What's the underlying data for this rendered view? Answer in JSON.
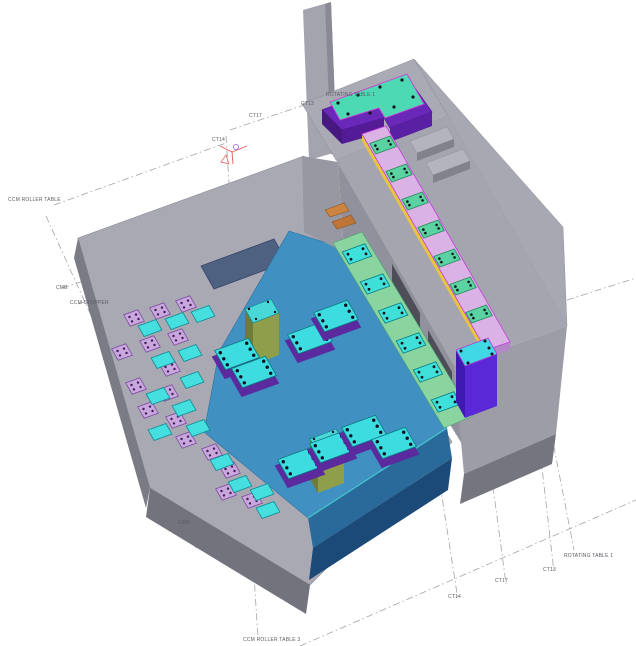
{
  "view": {
    "type": "isometric-3d-plant-layout",
    "description": "CAD 3D view of CCM roller table and rotating table area"
  },
  "labels": {
    "ccm_roller_table": "CCM ROLLER TABLE",
    "cmb_upper": "CMB",
    "ccm_stopper": "CCM STOPPER",
    "ct14_upper": "CT14",
    "ct17_upper": "CT17",
    "ct13_upper": "CT13",
    "rotating_table_upper": "ROTATING TABLE 1",
    "rotating_table_lower": "ROTATING TABLE 1",
    "ct13_lower": "CT13",
    "ct17_lower": "CT17",
    "ct14_lower": "CT14",
    "cmb_lower": "CMB",
    "ccm_roller_table_3": "CCM ROLLER TABLE 3"
  },
  "palette": {
    "deck_gray": "#a9a9b4",
    "pool_blue": "#4190c2",
    "pool_wall_dark": "#1c4a78",
    "strip_green": "#8ad4a0",
    "rail_pink": "#dbb2e6",
    "rail_outline_magenta": "#c83ae0",
    "safety_yellow": "#e8c53e",
    "table_violet": "#6a28b8",
    "table_top_teal": "#4cd9b4",
    "plate_cyan": "#3fe0da",
    "plate_lavender": "#c9a6dd",
    "pedestal_purple": "#5b28d8",
    "olive_box": "#8e9e4a",
    "ucs_marker_red": "#e05858"
  },
  "scene": {
    "axes": {
      "u": [
        0.94,
        -0.34
      ],
      "v": [
        0.5,
        0.87
      ]
    },
    "plate_types": {
      "lavender": {
        "w": 15,
        "h": 13,
        "fill": "#c9a6dd",
        "stroke": "#7a4a9e",
        "dot": "#3a2050",
        "dots": 4,
        "dr": 1.2
      },
      "deck_cyan": {
        "w": 19,
        "h": 12,
        "fill": "#45dfe0",
        "stroke": "#0e8a94",
        "dots": 0
      },
      "strip_plate": {
        "w": 24,
        "h": 14,
        "fill": "#3fe0da",
        "stroke": "#0b7a80",
        "dot": "#14141c",
        "dots": 4,
        "dr": 1.4
      },
      "rail_plate": {
        "w": 22,
        "h": 12,
        "fill": "#5ad2a2",
        "stroke": "#268a5c",
        "dot": "#14141c",
        "dots": 4,
        "dr": 1.3
      },
      "pool_plate": {
        "w": 36,
        "h": 22,
        "fill": "#3ddce0",
        "stroke": "#0b7a80",
        "dot": "#101020",
        "dots": 6,
        "dr": 1.7,
        "base": "#5a2a9e",
        "baseDy": 7
      }
    },
    "deck_plates_lavender": [
      [
        134,
        318
      ],
      [
        160,
        311
      ],
      [
        186,
        304
      ],
      [
        122,
        352
      ],
      [
        150,
        344
      ],
      [
        178,
        337
      ],
      [
        170,
        368
      ],
      [
        136,
        386
      ],
      [
        168,
        393
      ],
      [
        148,
        410
      ],
      [
        176,
        420
      ],
      [
        186,
        440
      ],
      [
        212,
        452
      ],
      [
        230,
        470
      ],
      [
        226,
        492
      ],
      [
        252,
        500
      ]
    ],
    "deck_plates_cyan": [
      [
        150,
        328
      ],
      [
        177,
        321
      ],
      [
        203,
        314
      ],
      [
        163,
        360
      ],
      [
        190,
        353
      ],
      [
        192,
        380
      ],
      [
        158,
        396
      ],
      [
        184,
        408
      ],
      [
        160,
        432
      ],
      [
        198,
        428
      ],
      [
        222,
        462
      ],
      [
        240,
        484
      ],
      [
        262,
        492
      ],
      [
        268,
        510
      ]
    ],
    "strip_plates": [
      [
        357,
        254
      ],
      [
        375,
        284
      ],
      [
        393,
        313
      ],
      [
        411,
        343
      ],
      [
        428,
        372
      ],
      [
        446,
        402
      ]
    ],
    "rail_plates": [
      [
        383,
        145
      ],
      [
        399,
        173
      ],
      [
        415,
        201
      ],
      [
        431,
        229
      ],
      [
        447,
        258
      ],
      [
        463,
        286
      ],
      [
        479,
        314
      ]
    ],
    "pool_plates": [
      [
        310,
        338
      ],
      [
        336,
        316
      ],
      [
        237,
        354
      ],
      [
        254,
        372
      ],
      [
        300,
        463
      ],
      [
        332,
        447
      ],
      [
        364,
        431
      ],
      [
        394,
        443
      ]
    ]
  }
}
